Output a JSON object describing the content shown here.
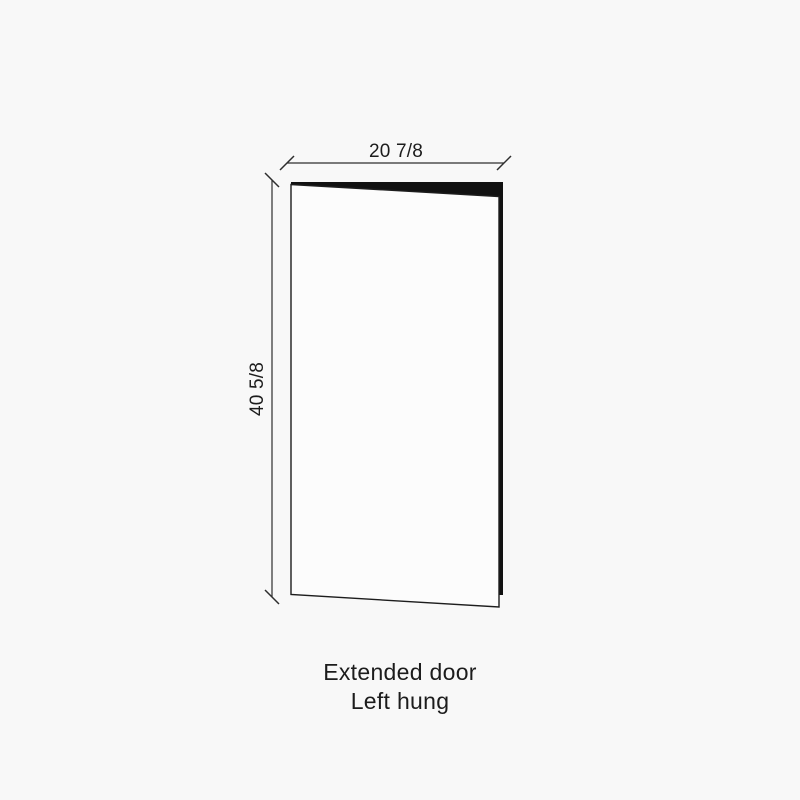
{
  "diagram": {
    "dimensions": {
      "width": {
        "label": "20 7/8"
      },
      "height": {
        "label": "40 5/8"
      }
    },
    "caption": {
      "line1": "Extended door",
      "line2": "Left hung"
    },
    "colors": {
      "background": "#f8f8f8",
      "ink": "#1c1c1c",
      "panel_fill": "#fcfcfc",
      "gap_fill": "#111111",
      "dimension_line": "#2e2e2e"
    }
  }
}
